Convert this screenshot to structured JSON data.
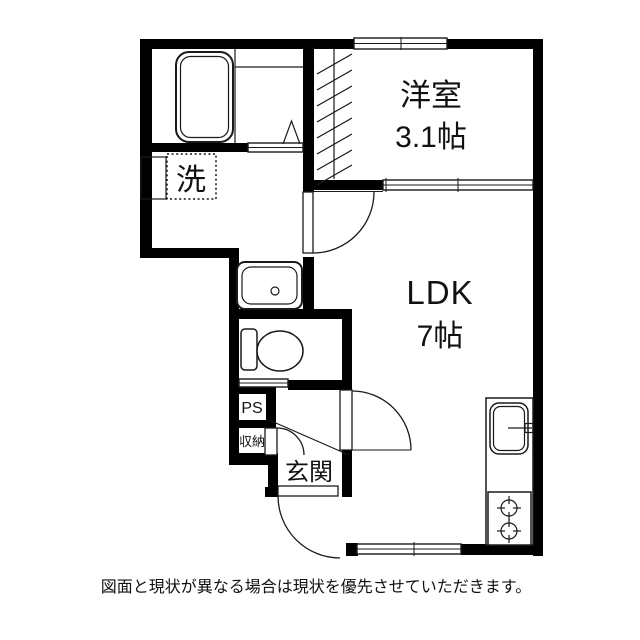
{
  "colors": {
    "wall": "#000000",
    "line": "#1a1a1a",
    "background": "#ffffff",
    "text": "#111111"
  },
  "rooms": {
    "western_room": {
      "name": "洋室",
      "size": "3.1帖"
    },
    "ldk": {
      "name": "LDK",
      "size": "7帖"
    },
    "entrance": {
      "name": "玄関"
    }
  },
  "labels": {
    "pipe_space": "PS",
    "storage": "収納",
    "laundry": "洗"
  },
  "note": "図面と現状が異なる場合は現状を優先させていただきます。"
}
